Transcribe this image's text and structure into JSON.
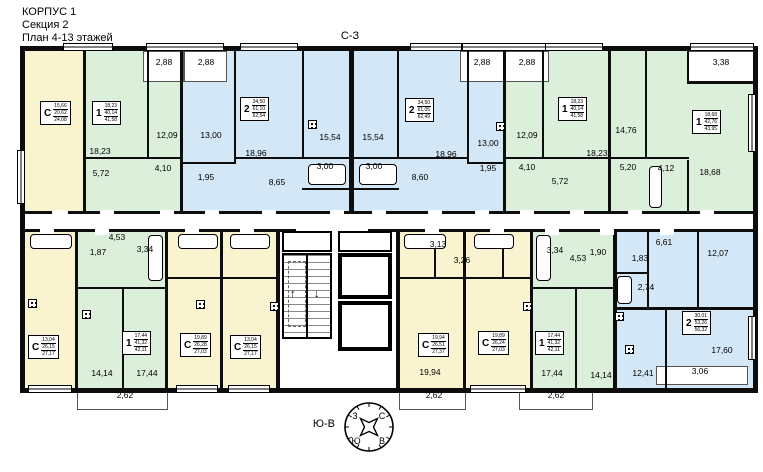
{
  "title": {
    "building": "КОРПУС 1",
    "section": "Секция 2",
    "floors": "План 4-13 этажей"
  },
  "orientation": {
    "top_label": "С-З",
    "bottom_label": "Ю-В",
    "compass": {
      "nw": "З",
      "ne": "С",
      "sw": "Ю",
      "se": "В"
    }
  },
  "legend_colors": {
    "studio": "#faf3d0",
    "one": "#dcefdb",
    "two": "#d4e7f6",
    "white": "#ffffff",
    "wall": "#0d0d0d"
  },
  "apartments": [
    {
      "letter": "С",
      "values": [
        "15,66",
        "20,62",
        "24,08"
      ],
      "x": 40,
      "y": 101
    },
    {
      "letter": "1",
      "values": [
        "18,23",
        "40,14",
        "41,58"
      ],
      "x": 92,
      "y": 101
    },
    {
      "letter": "2",
      "values": [
        "34,50",
        "61,10",
        "62,54"
      ],
      "x": 240,
      "y": 97
    },
    {
      "letter": "2",
      "values": [
        "34,50",
        "61,05",
        "62,49"
      ],
      "x": 405,
      "y": 98
    },
    {
      "letter": "1",
      "values": [
        "18,23",
        "40,14",
        "41,58"
      ],
      "x": 558,
      "y": 97
    },
    {
      "letter": "1",
      "values": [
        "18,68",
        "42,76",
        "43,95"
      ],
      "x": 692,
      "y": 110
    },
    {
      "letter": "С",
      "values": [
        "13,04",
        "26,15",
        "27,17"
      ],
      "x": 28,
      "y": 335
    },
    {
      "letter": "1",
      "values": [
        "17,44",
        "41,32",
        "42,11"
      ],
      "x": 122,
      "y": 331
    },
    {
      "letter": "С",
      "values": [
        "19,89",
        "26,28",
        "27,03"
      ],
      "x": 180,
      "y": 333
    },
    {
      "letter": "С",
      "values": [
        "13,04",
        "26,15",
        "27,17"
      ],
      "x": 230,
      "y": 335
    },
    {
      "letter": "С",
      "values": [
        "19,94",
        "26,51",
        "27,37"
      ],
      "x": 418,
      "y": 333
    },
    {
      "letter": "С",
      "values": [
        "19,89",
        "26,24",
        "27,03"
      ],
      "x": 478,
      "y": 331
    },
    {
      "letter": "1",
      "values": [
        "17,44",
        "41,32",
        "42,11"
      ],
      "x": 535,
      "y": 331
    },
    {
      "letter": "2",
      "values": [
        "30,01",
        "53,26",
        "56,32"
      ],
      "x": 682,
      "y": 311
    }
  ],
  "room_labels": [
    {
      "t": "2,88",
      "x": 164,
      "y": 62
    },
    {
      "t": "2,88",
      "x": 206,
      "y": 62
    },
    {
      "t": "2,88",
      "x": 482,
      "y": 62
    },
    {
      "t": "2,88",
      "x": 527,
      "y": 62
    },
    {
      "t": "3,38",
      "x": 721,
      "y": 62
    },
    {
      "t": "18,23",
      "x": 100,
      "y": 151
    },
    {
      "t": "12,09",
      "x": 167,
      "y": 135
    },
    {
      "t": "5,72",
      "x": 101,
      "y": 173
    },
    {
      "t": "4,10",
      "x": 163,
      "y": 168
    },
    {
      "t": "13,00",
      "x": 211,
      "y": 135
    },
    {
      "t": "18,96",
      "x": 256,
      "y": 153
    },
    {
      "t": "15,54",
      "x": 330,
      "y": 137
    },
    {
      "t": "3,00",
      "x": 325,
      "y": 166
    },
    {
      "t": "1,95",
      "x": 206,
      "y": 177
    },
    {
      "t": "8,65",
      "x": 277,
      "y": 182
    },
    {
      "t": "15,54",
      "x": 373,
      "y": 137
    },
    {
      "t": "3,00",
      "x": 374,
      "y": 166
    },
    {
      "t": "8,60",
      "x": 420,
      "y": 177
    },
    {
      "t": "18,96",
      "x": 446,
      "y": 154
    },
    {
      "t": "13,00",
      "x": 488,
      "y": 143
    },
    {
      "t": "1,95",
      "x": 488,
      "y": 168
    },
    {
      "t": "12,09",
      "x": 527,
      "y": 135
    },
    {
      "t": "4,10",
      "x": 527,
      "y": 167
    },
    {
      "t": "5,72",
      "x": 560,
      "y": 181
    },
    {
      "t": "18,23",
      "x": 597,
      "y": 153
    },
    {
      "t": "14,76",
      "x": 626,
      "y": 130
    },
    {
      "t": "5,20",
      "x": 628,
      "y": 167
    },
    {
      "t": "4,12",
      "x": 666,
      "y": 168
    },
    {
      "t": "18,68",
      "x": 710,
      "y": 172
    },
    {
      "t": "4,53",
      "x": 117,
      "y": 237
    },
    {
      "t": "1,87",
      "x": 98,
      "y": 252
    },
    {
      "t": "3,34",
      "x": 145,
      "y": 249
    },
    {
      "t": "14,14",
      "x": 102,
      "y": 373
    },
    {
      "t": "17,44",
      "x": 147,
      "y": 373
    },
    {
      "t": "2,62",
      "x": 125,
      "y": 395
    },
    {
      "t": "3,13",
      "x": 438,
      "y": 244
    },
    {
      "t": "3,26",
      "x": 462,
      "y": 260
    },
    {
      "t": "19,94",
      "x": 430,
      "y": 372
    },
    {
      "t": "2,62",
      "x": 434,
      "y": 395
    },
    {
      "t": "3,34",
      "x": 555,
      "y": 250
    },
    {
      "t": "4,53",
      "x": 578,
      "y": 258
    },
    {
      "t": "1,90",
      "x": 598,
      "y": 252
    },
    {
      "t": "17,44",
      "x": 552,
      "y": 373
    },
    {
      "t": "14,14",
      "x": 601,
      "y": 375
    },
    {
      "t": "2,62",
      "x": 556,
      "y": 395
    },
    {
      "t": "6,61",
      "x": 664,
      "y": 242
    },
    {
      "t": "1,83",
      "x": 640,
      "y": 258
    },
    {
      "t": "2,74",
      "x": 646,
      "y": 287
    },
    {
      "t": "12,07",
      "x": 718,
      "y": 253
    },
    {
      "t": "12,41",
      "x": 643,
      "y": 373
    },
    {
      "t": "17,60",
      "x": 722,
      "y": 350
    },
    {
      "t": "3,06",
      "x": 700,
      "y": 371
    }
  ],
  "plan": {
    "rooms": [
      {
        "x": 23,
        "y": 51,
        "w": 62,
        "h": 162,
        "c": "studio"
      },
      {
        "x": 85,
        "y": 51,
        "w": 97,
        "h": 162,
        "c": "one"
      },
      {
        "x": 182,
        "y": 51,
        "w": 168,
        "h": 162,
        "c": "two"
      },
      {
        "x": 354,
        "y": 51,
        "w": 151,
        "h": 162,
        "c": "two"
      },
      {
        "x": 505,
        "y": 51,
        "w": 105,
        "h": 162,
        "c": "one"
      },
      {
        "x": 610,
        "y": 51,
        "w": 145,
        "h": 162,
        "c": "one"
      },
      {
        "x": 23,
        "y": 232,
        "w": 54,
        "h": 156,
        "c": "studio"
      },
      {
        "x": 77,
        "y": 232,
        "w": 90,
        "h": 156,
        "c": "one"
      },
      {
        "x": 167,
        "y": 232,
        "w": 55,
        "h": 156,
        "c": "studio"
      },
      {
        "x": 222,
        "y": 232,
        "w": 56,
        "h": 156,
        "c": "studio"
      },
      {
        "x": 280,
        "y": 232,
        "w": 116,
        "h": 156,
        "c": "white"
      },
      {
        "x": 400,
        "y": 232,
        "w": 65,
        "h": 156,
        "c": "studio"
      },
      {
        "x": 465,
        "y": 232,
        "w": 67,
        "h": 156,
        "c": "studio"
      },
      {
        "x": 532,
        "y": 232,
        "w": 83,
        "h": 156,
        "c": "one"
      },
      {
        "x": 615,
        "y": 232,
        "w": 140,
        "h": 156,
        "c": "two"
      }
    ],
    "walls": [
      [
        20,
        46,
        738,
        5
      ],
      [
        20,
        388,
        738,
        5
      ],
      [
        20,
        46,
        5,
        347
      ],
      [
        753,
        46,
        5,
        347
      ],
      [
        20,
        211,
        738,
        3
      ],
      [
        20,
        229,
        738,
        3
      ],
      [
        83,
        46,
        3,
        168
      ],
      [
        147,
        46,
        2,
        113
      ],
      [
        180,
        46,
        3,
        168
      ],
      [
        234,
        46,
        2,
        118
      ],
      [
        302,
        46,
        2,
        113
      ],
      [
        349,
        46,
        5,
        168
      ],
      [
        397,
        46,
        2,
        113
      ],
      [
        467,
        46,
        2,
        118
      ],
      [
        503,
        46,
        3,
        168
      ],
      [
        542,
        46,
        2,
        113
      ],
      [
        608,
        46,
        3,
        168
      ],
      [
        645,
        46,
        2,
        113
      ],
      [
        687,
        160,
        2,
        54
      ],
      [
        687,
        46,
        2,
        37
      ],
      [
        83,
        157,
        99,
        2
      ],
      [
        180,
        162,
        56,
        2
      ],
      [
        234,
        157,
        118,
        2
      ],
      [
        302,
        188,
        49,
        2
      ],
      [
        354,
        157,
        115,
        2
      ],
      [
        354,
        188,
        45,
        2
      ],
      [
        467,
        162,
        38,
        2
      ],
      [
        503,
        157,
        107,
        2
      ],
      [
        608,
        157,
        81,
        2
      ],
      [
        687,
        81,
        70,
        3
      ],
      [
        75,
        229,
        3,
        164
      ],
      [
        165,
        229,
        3,
        164
      ],
      [
        220,
        229,
        3,
        164
      ],
      [
        276,
        229,
        4,
        164
      ],
      [
        396,
        229,
        4,
        164
      ],
      [
        463,
        229,
        3,
        164
      ],
      [
        530,
        229,
        3,
        164
      ],
      [
        613,
        229,
        4,
        164
      ],
      [
        75,
        287,
        92,
        2
      ],
      [
        122,
        287,
        2,
        101
      ],
      [
        165,
        277,
        57,
        2
      ],
      [
        220,
        277,
        58,
        2
      ],
      [
        398,
        277,
        134,
        2
      ],
      [
        434,
        229,
        2,
        50
      ],
      [
        502,
        229,
        2,
        50
      ],
      [
        530,
        287,
        85,
        2
      ],
      [
        575,
        287,
        2,
        101
      ],
      [
        613,
        307,
        142,
        3
      ],
      [
        647,
        229,
        2,
        80
      ],
      [
        697,
        229,
        2,
        80
      ],
      [
        613,
        272,
        36,
        2
      ],
      [
        665,
        307,
        2,
        83
      ]
    ],
    "balconies": [
      [
        143,
        51,
        41,
        31
      ],
      [
        184,
        51,
        43,
        31
      ],
      [
        460,
        51,
        44,
        31
      ],
      [
        504,
        51,
        45,
        31
      ],
      [
        687,
        51,
        68,
        31
      ],
      [
        77,
        391,
        91,
        19
      ],
      [
        399,
        391,
        67,
        19
      ],
      [
        519,
        391,
        74,
        19
      ],
      [
        656,
        366,
        92,
        19
      ]
    ],
    "windows": [
      [
        63,
        43,
        50,
        8
      ],
      [
        146,
        43,
        78,
        8
      ],
      [
        240,
        43,
        58,
        8
      ],
      [
        410,
        43,
        52,
        8
      ],
      [
        462,
        43,
        86,
        8
      ],
      [
        545,
        43,
        58,
        8
      ],
      [
        690,
        43,
        64,
        8
      ],
      [
        28,
        385,
        44,
        8
      ],
      [
        176,
        385,
        42,
        8
      ],
      [
        228,
        385,
        42,
        8
      ],
      [
        470,
        385,
        56,
        8
      ],
      [
        17,
        150,
        8,
        54
      ],
      [
        748,
        94,
        8,
        58
      ],
      [
        748,
        316,
        8,
        44
      ]
    ],
    "gaps": [
      [
        52,
        210,
        16,
        7
      ],
      [
        100,
        210,
        14,
        7
      ],
      [
        160,
        210,
        14,
        7
      ],
      [
        205,
        210,
        14,
        7
      ],
      [
        262,
        210,
        14,
        7
      ],
      [
        330,
        210,
        14,
        7
      ],
      [
        372,
        210,
        14,
        7
      ],
      [
        428,
        210,
        14,
        7
      ],
      [
        475,
        210,
        14,
        7
      ],
      [
        520,
        210,
        14,
        7
      ],
      [
        570,
        210,
        14,
        7
      ],
      [
        628,
        210,
        14,
        7
      ],
      [
        700,
        210,
        14,
        7
      ],
      [
        40,
        228,
        14,
        7
      ],
      [
        95,
        228,
        14,
        7
      ],
      [
        185,
        228,
        14,
        7
      ],
      [
        240,
        228,
        14,
        7
      ],
      [
        296,
        228,
        72,
        7
      ],
      [
        425,
        228,
        14,
        7
      ],
      [
        490,
        228,
        14,
        7
      ],
      [
        545,
        228,
        14,
        7
      ],
      [
        600,
        228,
        14,
        7
      ],
      [
        660,
        228,
        14,
        7
      ],
      [
        334,
        270,
        6,
        14
      ],
      [
        334,
        316,
        6,
        14
      ]
    ],
    "tubs": [
      [
        30,
        234,
        42,
        15
      ],
      [
        178,
        234,
        40,
        15
      ],
      [
        230,
        234,
        40,
        15
      ],
      [
        404,
        234,
        42,
        15
      ],
      [
        474,
        234,
        40,
        15
      ],
      [
        308,
        164,
        38,
        21
      ],
      [
        359,
        164,
        38,
        21
      ],
      [
        148,
        235,
        15,
        46
      ],
      [
        536,
        235,
        15,
        46
      ],
      [
        649,
        166,
        13,
        42
      ],
      [
        617,
        276,
        15,
        28
      ]
    ],
    "vents": [
      [
        28,
        299
      ],
      [
        82,
        310
      ],
      [
        196,
        300
      ],
      [
        270,
        302
      ],
      [
        308,
        120
      ],
      [
        496,
        122
      ],
      [
        523,
        302
      ],
      [
        615,
        312
      ],
      [
        625,
        345
      ]
    ]
  }
}
